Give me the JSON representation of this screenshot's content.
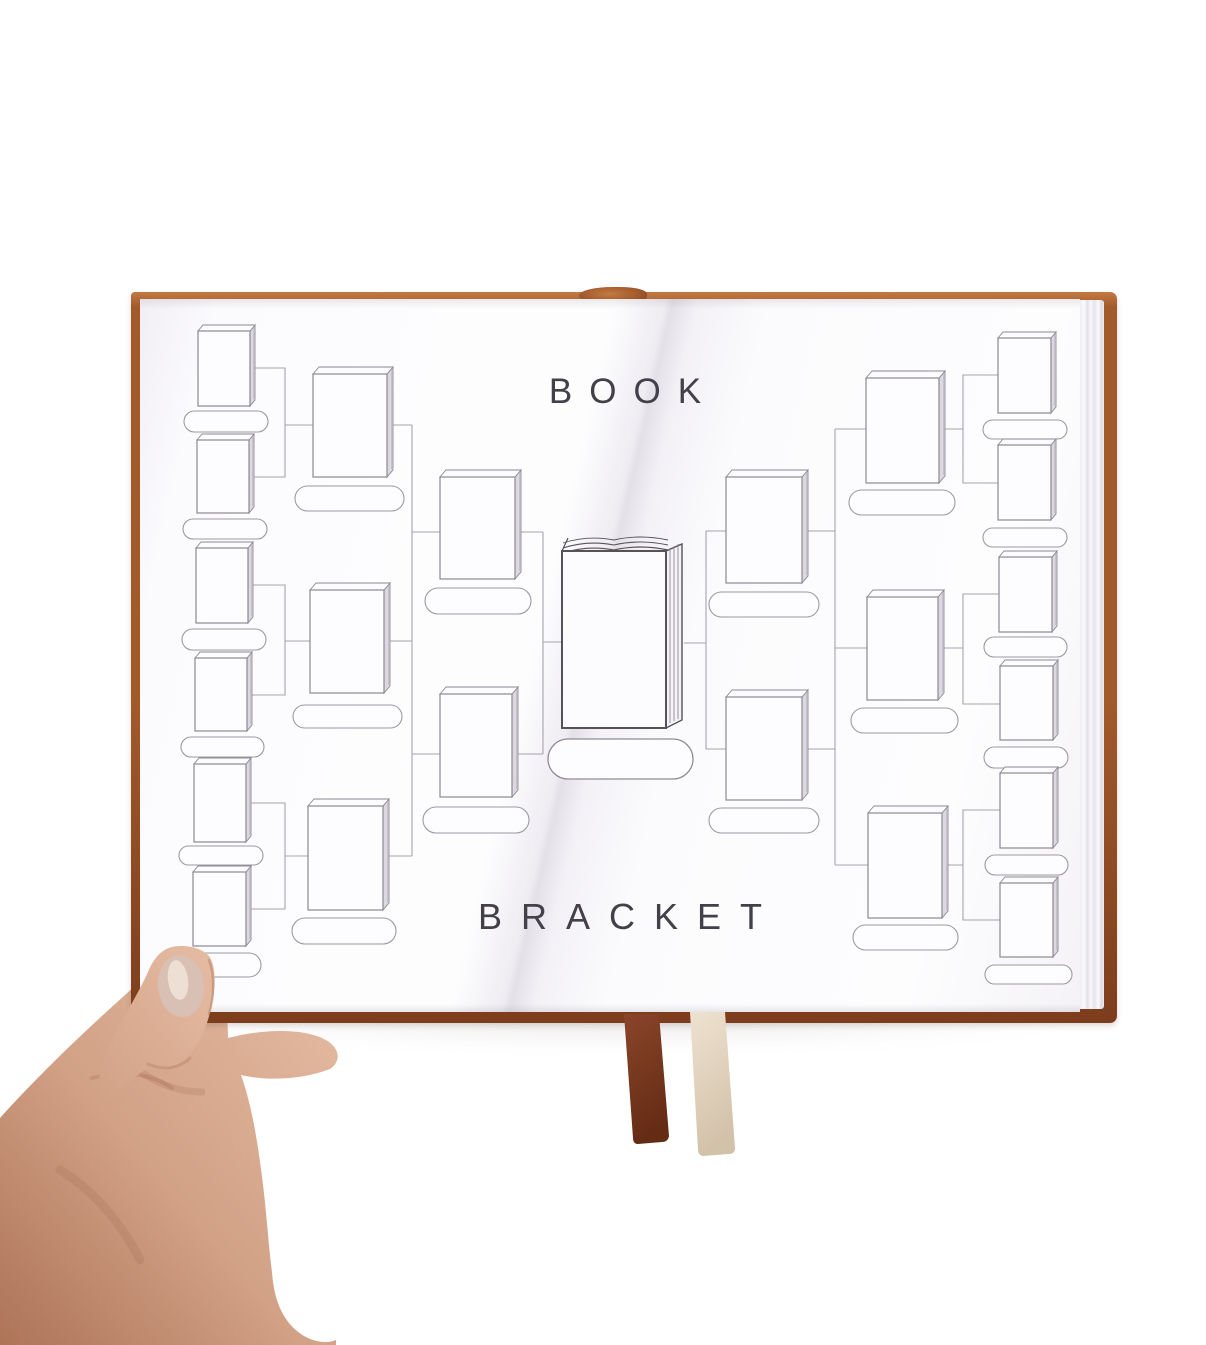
{
  "titles": {
    "top": "BOOK",
    "bottom": "BRACKET"
  },
  "scene": {
    "object": "open-hardcover-journal",
    "held_by": "left-hand",
    "bookmarks": [
      {
        "name": "leather-ribbon-bookmark",
        "color": "#8a452a"
      },
      {
        "name": "cream-ribbon-bookmark",
        "color": "#eee2d0"
      }
    ]
  },
  "colors": {
    "background": "#ffffff",
    "cover": "#a35a2b",
    "coverDark": "#7d3d1d",
    "coverEdgeHi": "#c37a42",
    "page": "#fdfdfe",
    "line": "#a7a3ae",
    "iconLine": "#8d8995",
    "iconEdge": "#dbd8df",
    "centerLine": "#55525a",
    "text": "#434049",
    "ribbonBrown": "#8a452a",
    "ribbonBrownDark": "#652c15",
    "ribbonCream": "#eee2d0",
    "ribbonCreamDark": "#d3c2aa",
    "skin": "#d2a186",
    "skinDark": "#ad7458",
    "skinLight": "#e5bda4",
    "nail": "#d9c0b5",
    "nailHi": "#f2e6dd"
  },
  "bracket": {
    "icon": "closed-book-icon",
    "center_icon": "open-book-icon",
    "rounds_left_slots": [
      6,
      3,
      2
    ],
    "rounds_right_slots": [
      6,
      3,
      2
    ],
    "slots": [
      {
        "b": [
          198,
          331,
          52,
          75
        ],
        "p": [
          184,
          411,
          84,
          21
        ]
      },
      {
        "b": [
          197,
          440,
          52,
          73
        ],
        "p": [
          183,
          519,
          84,
          20
        ]
      },
      {
        "b": [
          196,
          548,
          52,
          75
        ],
        "p": [
          182,
          629,
          84,
          21
        ]
      },
      {
        "b": [
          195,
          658,
          52,
          73
        ],
        "p": [
          181,
          737,
          83,
          20
        ]
      },
      {
        "b": [
          194,
          764,
          52,
          78
        ],
        "p": [
          179,
          846,
          84,
          19
        ]
      },
      {
        "b": [
          193,
          872,
          53,
          74
        ],
        "p": [
          180,
          953,
          81,
          24
        ]
      },
      {
        "b": [
          313,
          374,
          74,
          103
        ],
        "p": [
          295,
          486,
          109,
          25
        ]
      },
      {
        "b": [
          310,
          590,
          74,
          103
        ],
        "p": [
          293,
          705,
          109,
          23
        ]
      },
      {
        "b": [
          308,
          806,
          75,
          104
        ],
        "p": [
          292,
          918,
          104,
          26
        ]
      },
      {
        "b": [
          440,
          477,
          75,
          102
        ],
        "p": [
          425,
          588,
          106,
          26
        ]
      },
      {
        "b": [
          440,
          694,
          72,
          103
        ],
        "p": [
          423,
          807,
          106,
          26
        ]
      },
      {
        "b": [
          726,
          477,
          76,
          106
        ],
        "p": [
          709,
          592,
          110,
          25
        ]
      },
      {
        "b": [
          726,
          697,
          76,
          103
        ],
        "p": [
          709,
          808,
          110,
          25
        ]
      },
      {
        "b": [
          866,
          378,
          73,
          105
        ],
        "p": [
          849,
          490,
          106,
          25
        ]
      },
      {
        "b": [
          867,
          597,
          71,
          103
        ],
        "p": [
          851,
          708,
          107,
          25
        ]
      },
      {
        "b": [
          868,
          813,
          74,
          105
        ],
        "p": [
          853,
          925,
          105,
          25
        ]
      },
      {
        "b": [
          998,
          338,
          53,
          75
        ],
        "p": [
          983,
          420,
          84,
          19
        ]
      },
      {
        "b": [
          998,
          445,
          53,
          75
        ],
        "p": [
          983,
          528,
          84,
          19
        ]
      },
      {
        "b": [
          999,
          557,
          53,
          75
        ],
        "p": [
          984,
          637,
          83,
          20
        ]
      },
      {
        "b": [
          1000,
          666,
          53,
          74
        ],
        "p": [
          984,
          747,
          84,
          21
        ]
      },
      {
        "b": [
          1000,
          773,
          53,
          75
        ],
        "p": [
          985,
          855,
          83,
          20
        ]
      },
      {
        "b": [
          1000,
          883,
          53,
          74
        ],
        "p": [
          985,
          965,
          87,
          19
        ]
      }
    ],
    "center": {
      "b": [
        562,
        535,
        120,
        193
      ],
      "p": [
        548,
        739,
        145,
        40
      ]
    },
    "connectors": [
      [
        [
          250,
          368
        ],
        [
          285,
          368
        ],
        [
          285,
          477
        ],
        [
          249,
          477
        ]
      ],
      [
        [
          248,
          585
        ],
        [
          285,
          585
        ],
        [
          285,
          695
        ],
        [
          247,
          695
        ]
      ],
      [
        [
          246,
          803
        ],
        [
          285,
          803
        ],
        [
          285,
          909
        ],
        [
          246,
          909
        ]
      ],
      [
        [
          285,
          425
        ],
        [
          412,
          425
        ]
      ],
      [
        [
          285,
          641
        ],
        [
          412,
          641
        ]
      ],
      [
        [
          285,
          856
        ],
        [
          412,
          856
        ]
      ],
      [
        [
          412,
          425
        ],
        [
          412,
          856
        ]
      ],
      [
        [
          412,
          532
        ],
        [
          543,
          532
        ]
      ],
      [
        [
          412,
          754
        ],
        [
          543,
          754
        ]
      ],
      [
        [
          543,
          532
        ],
        [
          543,
          754
        ]
      ],
      [
        [
          543,
          642
        ],
        [
          563,
          642
        ]
      ],
      [
        [
          998,
          375
        ],
        [
          963,
          375
        ],
        [
          963,
          483
        ],
        [
          998,
          483
        ]
      ],
      [
        [
          999,
          594
        ],
        [
          963,
          594
        ],
        [
          963,
          704
        ],
        [
          1000,
          704
        ]
      ],
      [
        [
          1000,
          810
        ],
        [
          963,
          810
        ],
        [
          963,
          920
        ],
        [
          1000,
          920
        ]
      ],
      [
        [
          835,
          429
        ],
        [
          963,
          429
        ]
      ],
      [
        [
          835,
          648
        ],
        [
          963,
          648
        ]
      ],
      [
        [
          835,
          865
        ],
        [
          963,
          865
        ]
      ],
      [
        [
          835,
          429
        ],
        [
          835,
          865
        ]
      ],
      [
        [
          706,
          531
        ],
        [
          835,
          531
        ]
      ],
      [
        [
          706,
          749
        ],
        [
          835,
          749
        ]
      ],
      [
        [
          706,
          531
        ],
        [
          706,
          749
        ]
      ],
      [
        [
          684,
          643
        ],
        [
          706,
          643
        ]
      ]
    ]
  }
}
